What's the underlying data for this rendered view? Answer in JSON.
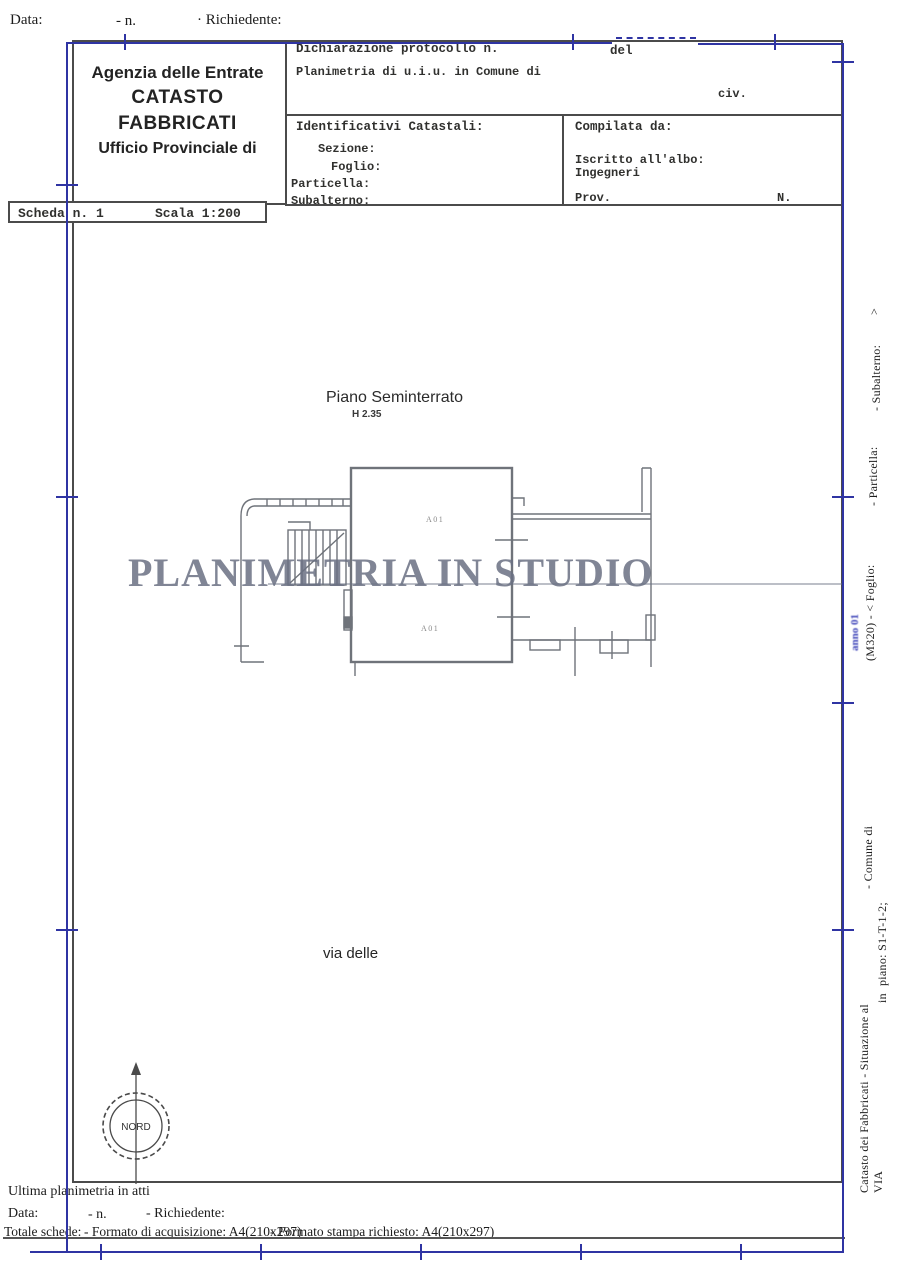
{
  "top_row": {
    "data": "Data:",
    "n": "- n.",
    "richiedente": "· Richiedente:"
  },
  "header": {
    "agency": "Agenzia delle Entrate",
    "registry": "CATASTO FABBRICATI",
    "office": "Ufficio Provinciale di"
  },
  "scheda_bar": {
    "scheda": "Scheda n. 1",
    "scala": "Scala 1:200"
  },
  "declaration": {
    "protocol": "Dichiarazione protocollo n.",
    "del": "del",
    "subject": "Planimetria di u.i.u. in Comune di",
    "civ": "civ."
  },
  "identificativi": {
    "title": "Identificativi Catastali:",
    "sezione": "Sezione:",
    "foglio": "Foglio:",
    "particella": "Particella:",
    "subalterno": "Subalterno:"
  },
  "compilata": {
    "title": "Compilata da:",
    "albo": "Iscritto all'albo:",
    "albo_value": "Ingegneri",
    "prov": "Prov.",
    "num": "N."
  },
  "plan": {
    "floor": "Piano Seminterrato",
    "height": "H 2.35",
    "room1": "A01",
    "room2": "A01",
    "street": "via delle",
    "compass": "NORD",
    "watermark": "PLANIMETRIA IN STUDIO"
  },
  "sidebar": {
    "catasto": "Catasto dei Fabbricati - Situazione al",
    "comune": "- Comune di",
    "code_foglio": "(M320) - < Foglio:",
    "particella": "- Particella:",
    "subalterno": "- Subalterno:",
    "close": ">",
    "via": "VIA",
    "in_word": "in",
    "piano": "piano: S1-T-1-2;",
    "blue_note": "anno 01"
  },
  "footer": {
    "ultima": "Ultima planimetria in atti",
    "data": "Data:",
    "n": "- n.",
    "richiedente": "- Richiedente:",
    "totale": "Totale schede:",
    "acquisizione": "- Formato di acquisizione: A4(210x297)",
    "stampa": "- Formato stampa richiesto: A4(210x297)"
  },
  "colors": {
    "registration_blue": "#2f34a3",
    "watermark": "#6a7082",
    "plan_line": "#6f737a"
  }
}
